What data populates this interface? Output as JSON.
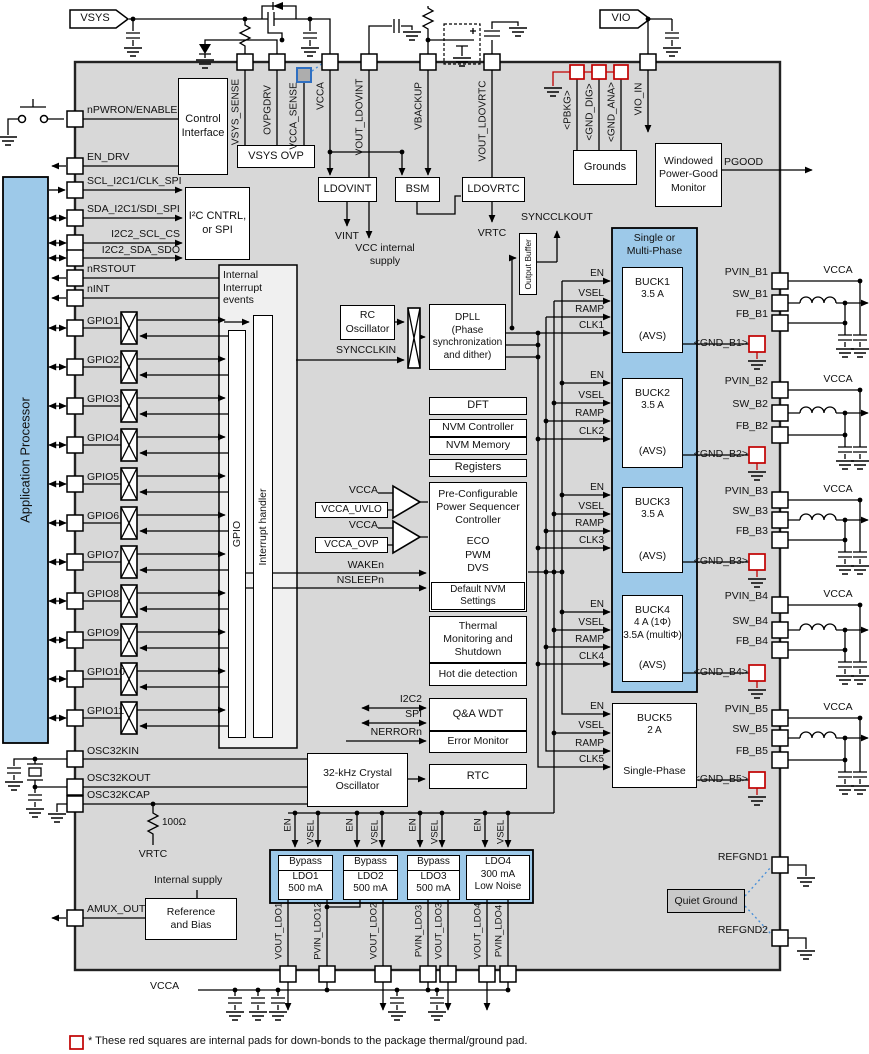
{
  "colors": {
    "chip": "#d8d8d8",
    "blue": "#9dc9e9",
    "red": "#c00000",
    "quiet": "#c9c9c9",
    "dotted": "#4a90d9"
  },
  "flags": {
    "vsys": "VSYS",
    "vio": "VIO"
  },
  "top_pins": [
    "VSYS_SENSE",
    "OVPGDRV",
    "VCCA_SENSE",
    "VCCA",
    "VOUT_LDOVINT",
    "VBACKUP",
    "VOUT_LDOVRTC"
  ],
  "ground_pins": [
    "<PBKG>",
    "<GND_DIG>",
    "<GND_ANA>"
  ],
  "vio_in": "VIO_IN",
  "left_pins": [
    "nPWRON/ENABLE",
    "EN_DRV",
    "SCL_I2C1/CLK_SPI",
    "SDA_I2C1/SDI_SPI",
    "I2C2_SCL_CS",
    "I2C2_SDA_SDO",
    "nRSTOUT",
    "nINT"
  ],
  "gpio_pins": [
    "GPIO1",
    "GPIO2",
    "GPIO3",
    "GPIO4",
    "GPIO5",
    "GPIO6",
    "GPIO7",
    "GPIO8",
    "GPIO9",
    "GPIO10",
    "GPIO11"
  ],
  "osc_pins": [
    "OSC32KIN",
    "OSC32KOUT",
    "OSC32KCAP"
  ],
  "amux": "AMUX_OUT",
  "refgnd": [
    "REFGND1",
    "REFGND2"
  ],
  "bottom_pins": [
    "VOUT_LDO1",
    "PVIN_LDO12",
    "VOUT_LDO2",
    "PVIN_LDO3",
    "VOUT_LDO3",
    "VOUT_LDO4",
    "PVIN_LDO4"
  ],
  "blocks": {
    "ap": "Application Processor",
    "control_interface": "Control\nInterface",
    "i2c_cntrl": "I²C CNTRL,\nor SPI",
    "vsys_ovp": "VSYS OVP",
    "ldovint": "LDOVINT",
    "bsm": "BSM",
    "ldovrtc": "LDOVRTC",
    "grounds": "Grounds",
    "pg_monitor": "Windowed\nPower-Good\nMonitor",
    "interrupt_events": "Internal\nInterrupt\nevents",
    "gpio_bar": "GPIO",
    "interrupt_handler": "Interrupt handler",
    "rc_osc": "RC\nOscillator",
    "dpll": "DPLL\n(Phase\nsynchronization\nand dither)",
    "output_buffer": "Output Buffer",
    "dft": "DFT",
    "nvm_controller": "NVM Controller",
    "nvm_memory": "NVM Memory",
    "registers": "Registers",
    "sequencer": "Pre-Configurable\nPower Sequencer\nController",
    "sequencer_modes": "ECO\nPWM\nDVS",
    "sequencer_footer": "Default NVM Settings",
    "thermal": "Thermal\nMonitoring and\nShutdown",
    "hot_die": "Hot die detection",
    "wdt": "Q&A WDT",
    "error_monitor": "Error Monitor",
    "xtal_osc": "32-kHz Crystal\nOscillator",
    "rtc": "RTC",
    "reference": "Reference\nand Bias",
    "quiet_ground": "Quiet Ground",
    "buck_container": "Single or\nMulti-Phase"
  },
  "signals": {
    "pgood": "PGOOD",
    "vint": "VINT",
    "vcc_supply": "VCC internal\nsupply",
    "vrtc_top": "VRTC",
    "syncclkout": "SYNCCLKOUT",
    "syncclkin": "SYNCCLKIN",
    "vcca1": "VCCA",
    "vcca_uvlo": "VCCA_UVLO",
    "vcca2": "VCCA",
    "vcca_ovp": "VCCA_OVP",
    "waken": "WAKEn",
    "nsleepn": "NSLEEPn",
    "i2c2": "I2C2",
    "spi": "SPI",
    "nerrorn": "NERRORn",
    "res100": "100Ω",
    "vrtc_bottom": "VRTC",
    "internal_supply": "Internal supply",
    "vcca_bottom": "VCCA"
  },
  "ldo_ctrl": {
    "en": "EN",
    "vsel": "VSEL"
  },
  "bucks": [
    {
      "name": "BUCK1",
      "rating": "3.5 A",
      "mode": "(AVS)",
      "inputs": [
        "EN",
        "VSEL",
        "RAMP",
        "CLK1"
      ],
      "pins": [
        "PVIN_B1",
        "SW_B1",
        "FB_B1"
      ],
      "gnd": "<GND_B1>",
      "vcca": "VCCA"
    },
    {
      "name": "BUCK2",
      "rating": "3.5 A",
      "mode": "(AVS)",
      "inputs": [
        "EN",
        "VSEL",
        "RAMP",
        "CLK2"
      ],
      "pins": [
        "PVIN_B2",
        "SW_B2",
        "FB_B2"
      ],
      "gnd": "<GND_B2>",
      "vcca": "VCCA"
    },
    {
      "name": "BUCK3",
      "rating": "3.5 A",
      "mode": "(AVS)",
      "inputs": [
        "EN",
        "VSEL",
        "RAMP",
        "CLK3"
      ],
      "pins": [
        "PVIN_B3",
        "SW_B3",
        "FB_B3"
      ],
      "gnd": "<GND_B3>",
      "vcca": "VCCA"
    },
    {
      "name": "BUCK4",
      "rating": "4 A (1Φ)\n3.5A (multiΦ)",
      "mode": "(AVS)",
      "inputs": [
        "EN",
        "VSEL",
        "RAMP",
        "CLK4"
      ],
      "pins": [
        "PVIN_B4",
        "SW_B4",
        "FB_B4"
      ],
      "gnd": "<GND_B4>",
      "vcca": "VCCA"
    },
    {
      "name": "BUCK5",
      "rating": "2 A",
      "mode": "Single-Phase",
      "inputs": [
        "EN",
        "VSEL",
        "RAMP",
        "CLK5"
      ],
      "pins": [
        "PVIN_B5",
        "SW_B5",
        "FB_B5"
      ],
      "gnd": "<GND_B5>",
      "vcca": "VCCA"
    }
  ],
  "ldos": [
    {
      "bypass": "Bypass",
      "name": "LDO1",
      "rating": "500 mA"
    },
    {
      "bypass": "Bypass",
      "name": "LDO2",
      "rating": "500 mA"
    },
    {
      "bypass": "Bypass",
      "name": "LDO3",
      "rating": "500 mA"
    },
    {
      "name": "LDO4",
      "rating": "300 mA",
      "note": "Low Noise"
    }
  ],
  "footnote": "* These red squares are internal pads for down-bonds to the package thermal/ground pad."
}
